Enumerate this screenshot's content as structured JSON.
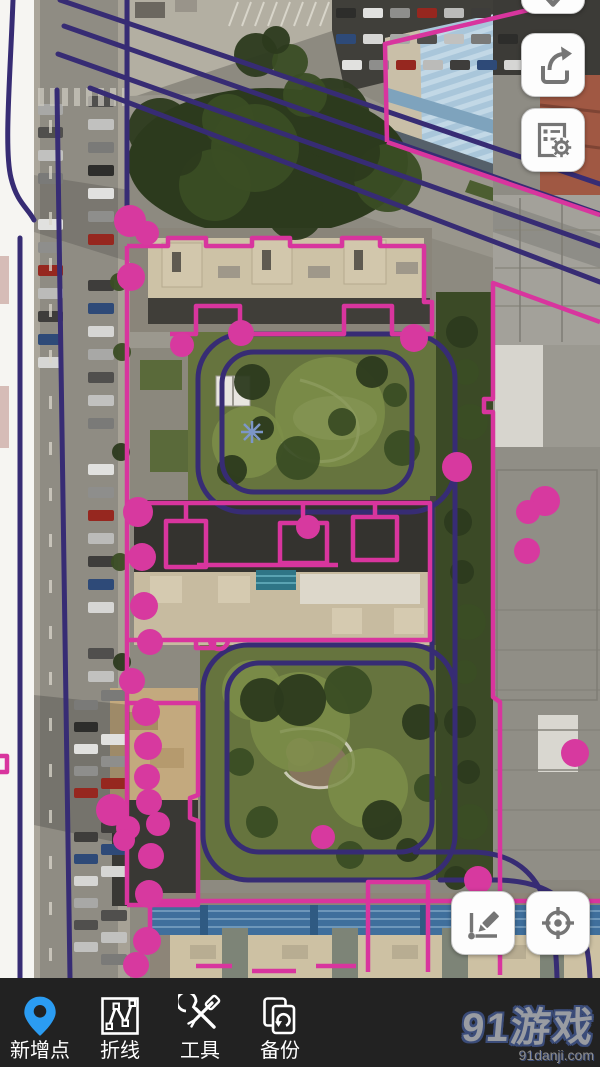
{
  "app": {
    "type": "map-annotation",
    "platform": "mobile"
  },
  "map": {
    "imagery": "satellite",
    "marker_color": "#d7399f",
    "polygon_color": "#d8359e",
    "polyline_color": "#372c74",
    "markers": [
      [
        130,
        221,
        16
      ],
      [
        147,
        233,
        12
      ],
      [
        131,
        277,
        14
      ],
      [
        182,
        345,
        12
      ],
      [
        241,
        333,
        13
      ],
      [
        414,
        338,
        14
      ],
      [
        457,
        467,
        15
      ],
      [
        545,
        501,
        15
      ],
      [
        528,
        512,
        12
      ],
      [
        527,
        551,
        13
      ],
      [
        308,
        527,
        12
      ],
      [
        138,
        512,
        15
      ],
      [
        142,
        557,
        14
      ],
      [
        144,
        606,
        14
      ],
      [
        150,
        642,
        13
      ],
      [
        132,
        681,
        13
      ],
      [
        146,
        712,
        14
      ],
      [
        148,
        746,
        14
      ],
      [
        147,
        777,
        13
      ],
      [
        149,
        802,
        13
      ],
      [
        158,
        824,
        12
      ],
      [
        112,
        810,
        16
      ],
      [
        128,
        828,
        12
      ],
      [
        124,
        840,
        11
      ],
      [
        151,
        856,
        13
      ],
      [
        149,
        894,
        14
      ],
      [
        147,
        941,
        14
      ],
      [
        136,
        965,
        13
      ],
      [
        323,
        837,
        12
      ],
      [
        575,
        753,
        14
      ],
      [
        478,
        880,
        14
      ]
    ]
  },
  "controls": {
    "collapse": {
      "icon": "chevron-down-icon"
    },
    "share": {
      "icon": "share-icon"
    },
    "layer_settings": {
      "icon": "list-gear-icon"
    },
    "draw": {
      "icon": "polyline-pencil-icon"
    },
    "locate": {
      "icon": "crosshair-icon"
    }
  },
  "toolbar": {
    "background": "#222222",
    "items": [
      {
        "id": "add-point",
        "label": "新增点",
        "icon": "pin-icon",
        "icon_color": "#2b9cf2"
      },
      {
        "id": "polyline",
        "label": "折线",
        "icon": "polyline-icon"
      },
      {
        "id": "tools",
        "label": "工具",
        "icon": "tools-icon"
      },
      {
        "id": "backup",
        "label": "备份",
        "icon": "backup-icon"
      }
    ]
  },
  "watermark": {
    "title": "91游戏",
    "domain": "91danji.com"
  }
}
